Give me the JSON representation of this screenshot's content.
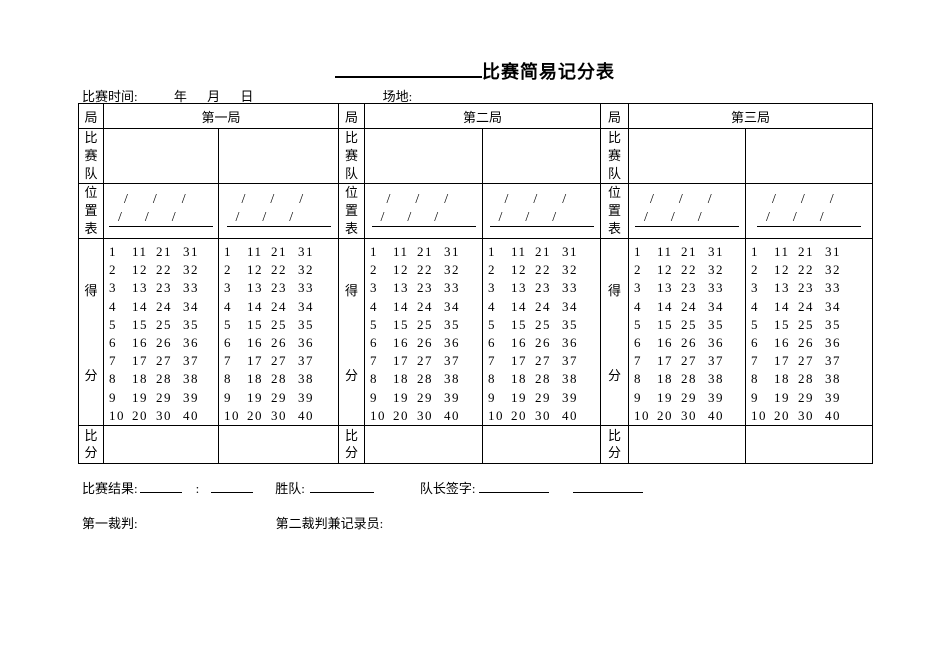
{
  "title": {
    "text": "比赛简易记分表"
  },
  "info": {
    "time_label": "比赛时间:",
    "year": "年",
    "month": "月",
    "day": "日",
    "venue_label": "场地:"
  },
  "table": {
    "sections": [
      {
        "game_label": "局",
        "title": "第一局"
      },
      {
        "game_label": "局",
        "title": "第二局"
      },
      {
        "game_label": "局",
        "title": "第三局"
      }
    ],
    "row_labels": {
      "teams": "比赛队",
      "positions": "位置表",
      "score_top": "得",
      "score_bottom": "分",
      "final": "比分"
    }
  },
  "position_pattern": {
    "rows": [
      [
        "/",
        "/",
        "/"
      ],
      [
        "/",
        "/",
        "/"
      ]
    ]
  },
  "score_grid": {
    "rows": [
      [
        "1",
        "11",
        "21",
        "31"
      ],
      [
        "2",
        "12",
        "22",
        "32"
      ],
      [
        "3",
        "13",
        "23",
        "33"
      ],
      [
        "4",
        "14",
        "24",
        "34"
      ],
      [
        "5",
        "15",
        "25",
        "35"
      ],
      [
        "6",
        "16",
        "26",
        "36"
      ],
      [
        "7",
        "17",
        "27",
        "37"
      ],
      [
        "8",
        "18",
        "28",
        "38"
      ],
      [
        "9",
        "19",
        "29",
        "39"
      ],
      [
        "10",
        "20",
        "30",
        "40"
      ]
    ]
  },
  "footer": {
    "result_label": "比赛结果:",
    "result_separator": ":",
    "winner_label": "胜队:",
    "captain_label": "队长签字:",
    "referee1_label": "第一裁判:",
    "referee2_label": "第二裁判兼记录员:"
  },
  "colors": {
    "text": "#000000",
    "border": "#000000",
    "background": "#ffffff"
  }
}
